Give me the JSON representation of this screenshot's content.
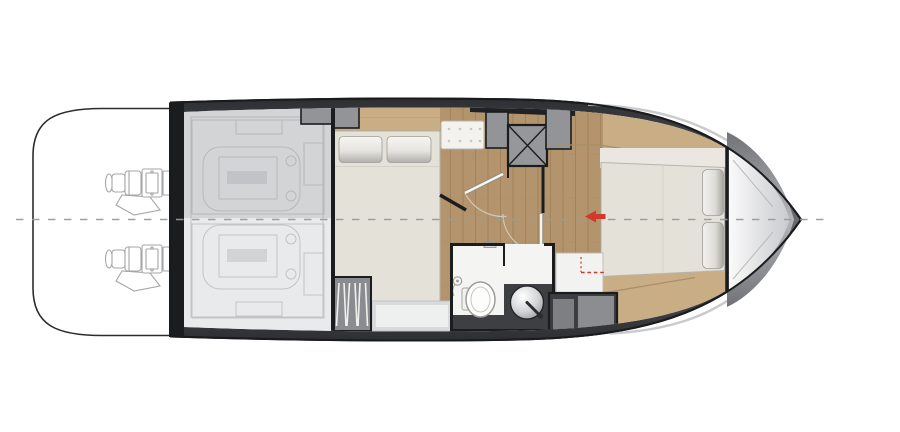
{
  "figure": {
    "type": "boat-floor-plan",
    "subject": "Motor yacht lower-deck floor plan, bow to the right",
    "deck_sections": [
      {
        "id": "swim-platform",
        "label": "Swim platform with twin sterndrive engines"
      },
      {
        "id": "engine-room",
        "label": "Engine room with twin engines (shaded technical area)"
      },
      {
        "id": "guest-cabin",
        "label": "Mid cabin with double berth, bench seat and wardrobes"
      },
      {
        "id": "companionway-steps",
        "label": "Companionway steps (hatched)"
      },
      {
        "id": "lobby",
        "label": "Lobby corridor with doors to cabin and head"
      },
      {
        "id": "technical-space",
        "label": "Technical space marked with crossed square"
      },
      {
        "id": "head",
        "label": "Head with shower, toilet and round washbasin"
      },
      {
        "id": "owner-cabin",
        "label": "Forward owner's cabin with island double berth"
      },
      {
        "id": "bow-deck",
        "label": "Bow section with V-shaped foredeck"
      }
    ],
    "marks": [
      {
        "id": "centerline",
        "label": "Dashed hull centerline"
      },
      {
        "id": "entry-arrow",
        "label": "Red arrow pointing aft at owner's cabin entry"
      },
      {
        "id": "red-dashed-bracket",
        "label": "Red dashed reference mark beside the head"
      }
    ]
  },
  "colors": {
    "background": "#ffffff",
    "hull_outline": "#1a1b1d",
    "hull_band": "#46474a",
    "wall": "#1b1c1e",
    "wood_light": "#c9ae85",
    "wood_mid": "#b3946c",
    "plank_seam": "#987a54",
    "linen": "#e4e1d8",
    "pillow_light": "#f4f3f0",
    "pillow_dark": "#b3b2ac",
    "cabinet_gray": "#939498",
    "overlay_gray": "#97989b",
    "bath_dark": "#3e3f42",
    "bath_white": "#f4f4f2",
    "lineart": "#c3c4c6",
    "engine_lineart": "#a5a6a8",
    "accent_red": "#d0392b",
    "centerline_gray": "#9a9b9d",
    "bench_white": "#f3f2ef"
  }
}
